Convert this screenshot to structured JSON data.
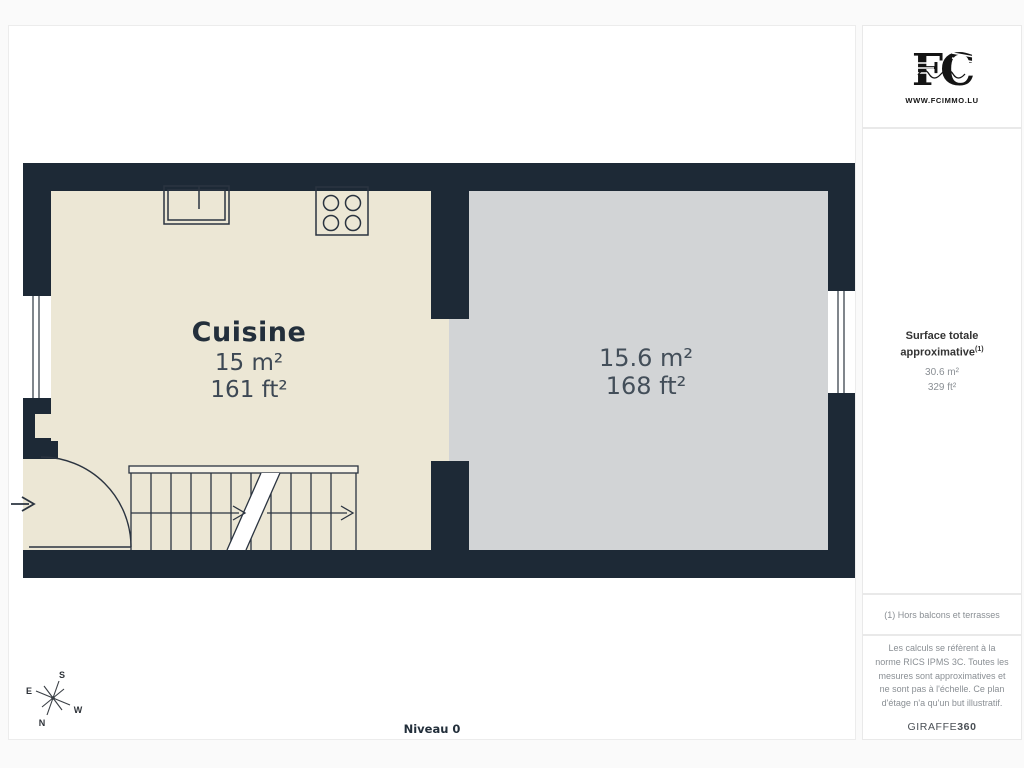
{
  "colors": {
    "wall": "#1d2936",
    "room_kitchen": "#ece7d5",
    "room_other": "#d2d4d6",
    "line": "#2b3440",
    "label_dark": "#232f3b",
    "label_muted": "#3d4854"
  },
  "plan": {
    "level_label": "Niveau 0",
    "rooms": [
      {
        "name": "Cuisine",
        "area_m2": "15 m²",
        "area_ft2": "161 ft²"
      },
      {
        "name": "",
        "area_m2": "15.6 m²",
        "area_ft2": "168 ft²"
      }
    ],
    "compass": {
      "north": "N",
      "south": "S",
      "east": "E",
      "west": "W"
    }
  },
  "sidebar": {
    "logo": {
      "monogram": "FC",
      "url_text": "WWW.FCIMMO.LU"
    },
    "surface_panel": {
      "title": "Surface totale approximative",
      "title_sup": "(1)",
      "total_m2": "30.6 m²",
      "total_ft2": "329 ft²"
    },
    "footnote": "(1) Hors balcons et terrasses",
    "disclaimer": "Les calculs se réfèrent à la norme RICS IPMS 3C. Toutes les mesures sont approximatives et ne sont pas à l'échelle. Ce plan d'étage n'a qu'un but illustratif.",
    "brand": {
      "name": "GIRAFFE",
      "suffix": "360"
    }
  }
}
